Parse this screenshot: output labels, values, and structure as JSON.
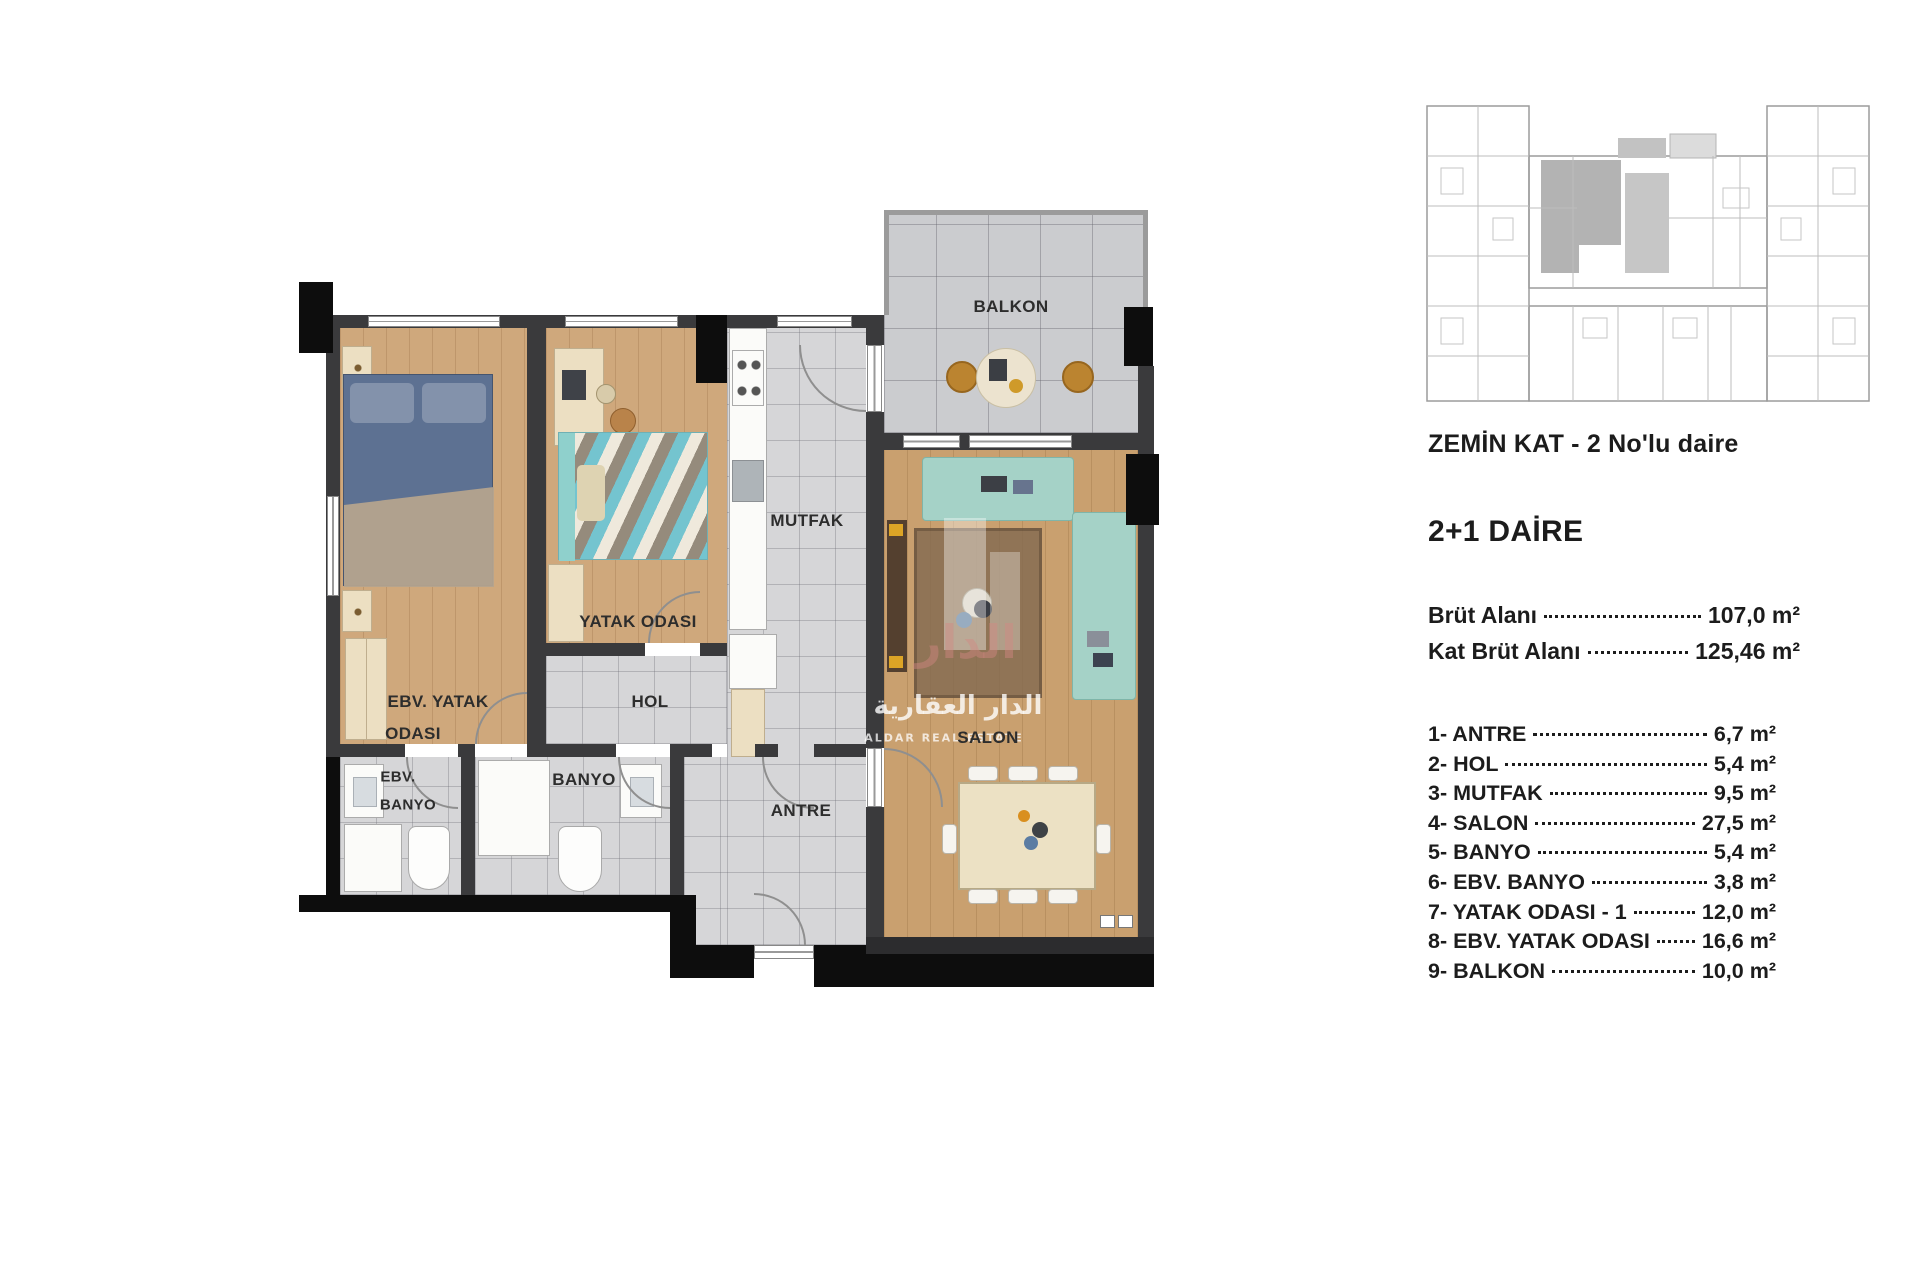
{
  "floor_plan": {
    "labels": {
      "balkon": "BALKON",
      "mutfak": "MUTFAK",
      "yatak_odasi": "YATAK ODASI",
      "ebv_yatak_1": "EBV. YATAK",
      "ebv_yatak_2": "ODASI",
      "hol": "HOL",
      "antre": "ANTRE",
      "banyo": "BANYO",
      "ebv_banyo_1": "EBV.",
      "ebv_banyo_2": "BANYO",
      "salon": "SALON"
    },
    "watermark": {
      "arabic_big": "الدار",
      "arabic": "الدار العقارية",
      "latin": "ALDAR REAL ESTATE"
    },
    "colors": {
      "wall": "#3a3a3c",
      "wall_black": "#0d0d0d",
      "wood": "#cfa87c",
      "tile": "#d6d6d8",
      "sofa_teal": "#a5d2c7",
      "bed_blue": "#5d7192"
    }
  },
  "key_plan": {
    "caption": "ZEMİN KAT - 2 No'lu daire",
    "highlight_color": "#b3b3b3"
  },
  "details": {
    "title": "2+1 DAİRE",
    "areas": [
      {
        "label": "Brüt Alanı",
        "value": "107,0 m²"
      },
      {
        "label": "Kat Brüt Alanı",
        "value": "125,46 m²"
      }
    ],
    "rooms": [
      {
        "label": "1- ANTRE",
        "value": "6,7 m²"
      },
      {
        "label": "2- HOL",
        "value": "5,4 m²"
      },
      {
        "label": "3- MUTFAK",
        "value": "9,5 m²"
      },
      {
        "label": "4- SALON",
        "value": "27,5 m²"
      },
      {
        "label": "5- BANYO",
        "value": "5,4 m²"
      },
      {
        "label": "6- EBV. BANYO",
        "value": "3,8 m²"
      },
      {
        "label": "7- YATAK ODASI - 1",
        "value": "12,0 m²"
      },
      {
        "label": "8- EBV. YATAK ODASI",
        "value": "16,6 m²"
      },
      {
        "label": "9- BALKON",
        "value": "10,0 m²"
      }
    ]
  }
}
